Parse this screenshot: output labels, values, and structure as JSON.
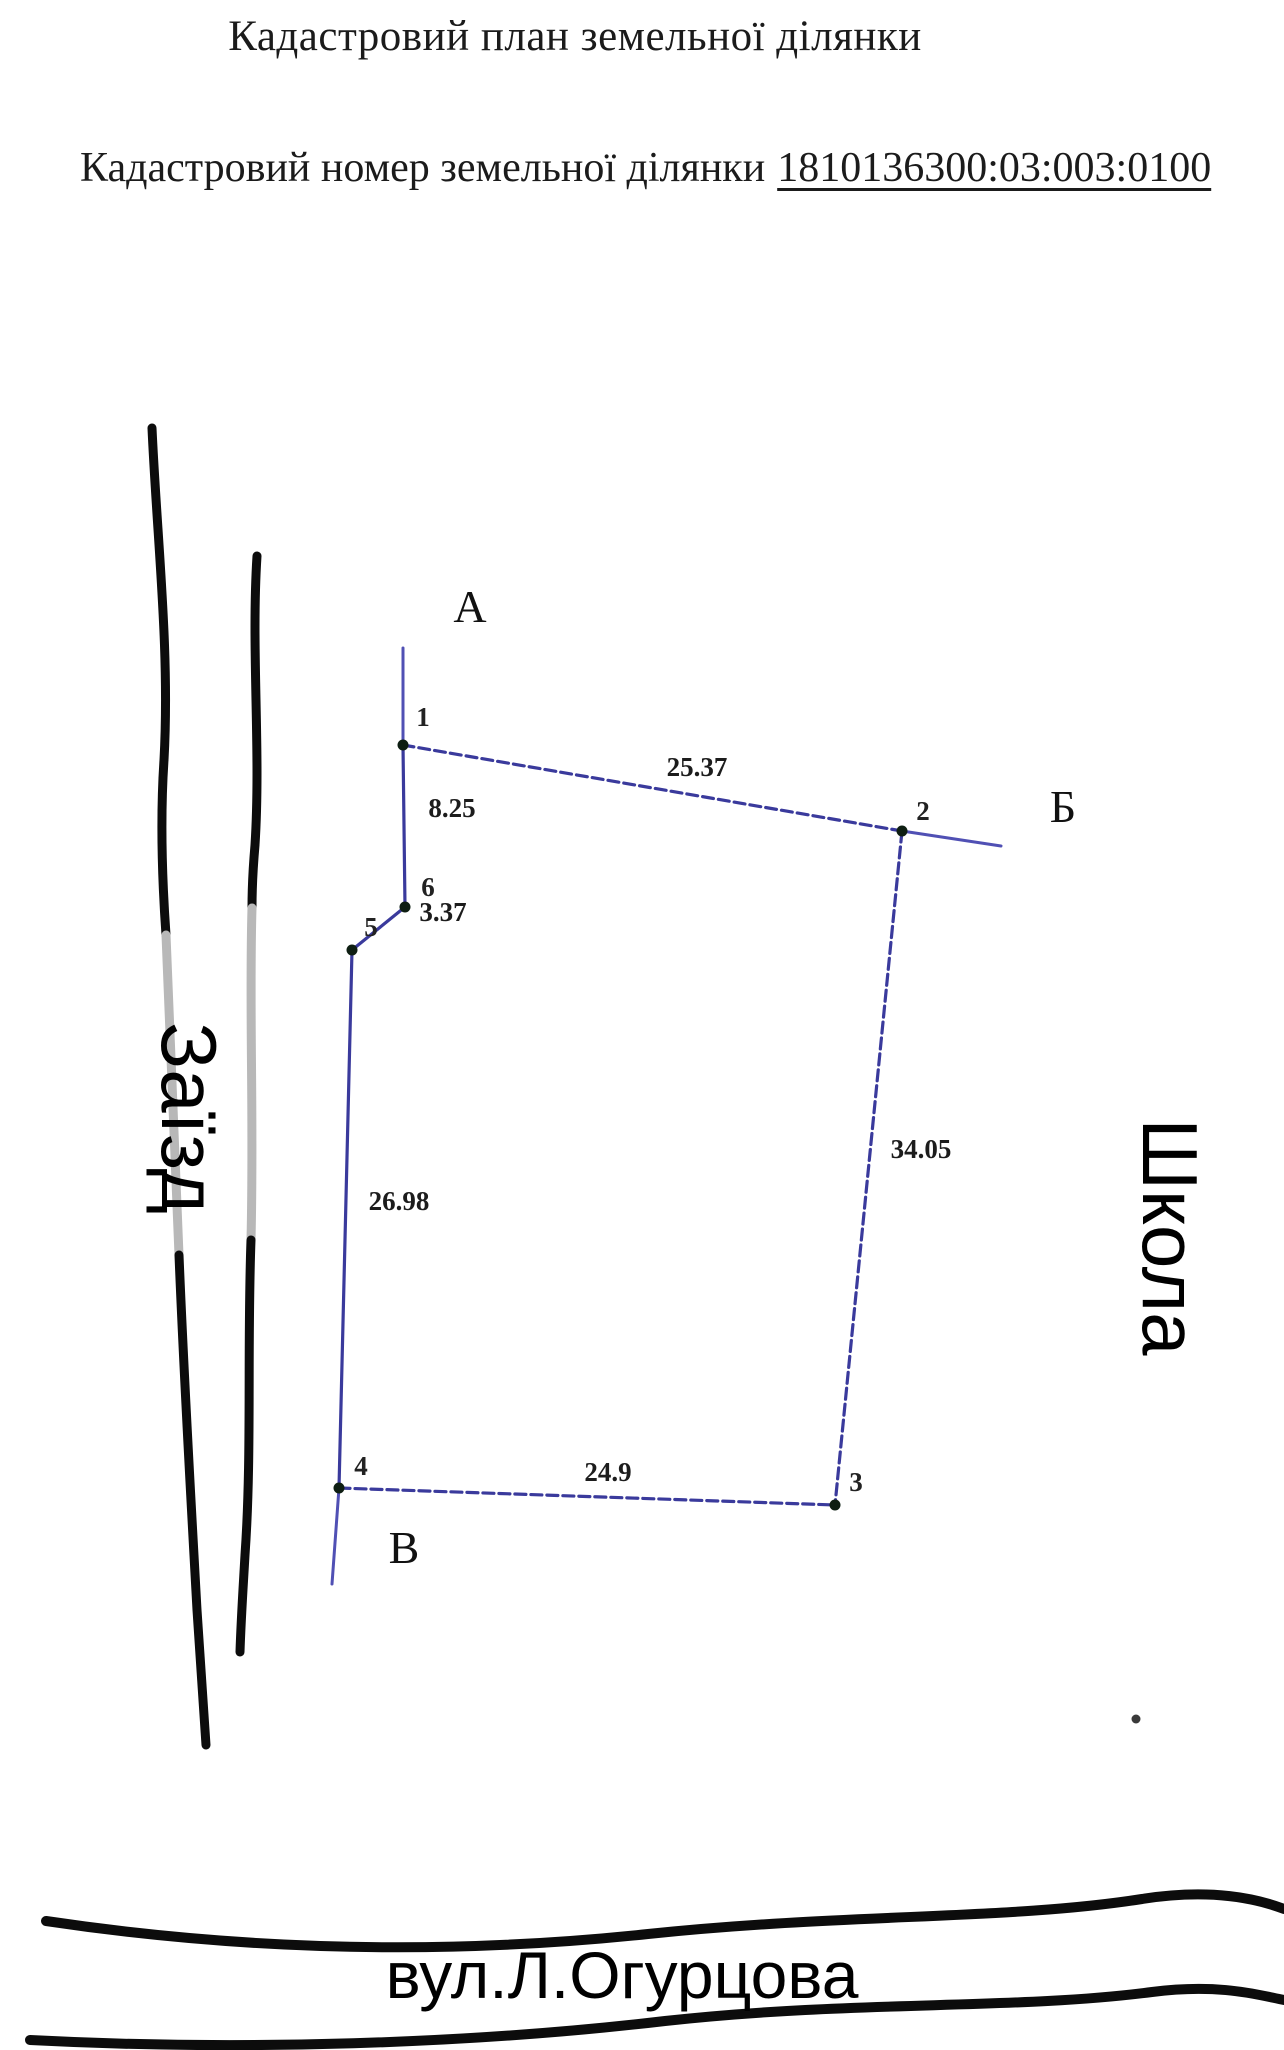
{
  "header": {
    "title": "Кадастровий план земельної ділянки",
    "subtitle_label": "Кадастровий номер земельної ділянки",
    "cadastral_number": "1810136300:03:003:0100"
  },
  "roads": {
    "left_label": "Заїзд",
    "right_label": "Школа",
    "bottom_label": "вул.Л.Огурцова"
  },
  "diagram": {
    "edge_color": "#3a3a9c",
    "extension_color": "#5050b4",
    "dot_color": "#0e1e12",
    "points": {
      "1": [
        403,
        745
      ],
      "2": [
        902,
        831
      ],
      "3": [
        835,
        1505
      ],
      "4": [
        339,
        1488
      ],
      "5": [
        352,
        950
      ],
      "6": [
        405,
        907
      ]
    },
    "edges": [
      {
        "from": "1",
        "to": "2",
        "length": "25.37",
        "label_pos": [
          697,
          776
        ],
        "dashed": true
      },
      {
        "from": "2",
        "to": "3",
        "length": "34.05",
        "label_pos": [
          921,
          1158
        ],
        "dashed": true
      },
      {
        "from": "4",
        "to": "3",
        "length": "24.9",
        "label_pos": [
          608,
          1481
        ],
        "dashed": true
      },
      {
        "from": "5",
        "to": "4",
        "length": "26.98",
        "label_pos": [
          399,
          1210
        ],
        "dashed": false
      },
      {
        "from": "6",
        "to": "5",
        "length": "3.37",
        "label_pos": [
          443,
          921
        ],
        "dashed": false
      },
      {
        "from": "1",
        "to": "6",
        "length": "8.25",
        "label_pos": [
          452,
          817
        ],
        "dashed": false
      }
    ],
    "extensions": [
      {
        "from": [
          403,
          648
        ],
        "to": [
          403,
          745
        ]
      },
      {
        "from": [
          902,
          831
        ],
        "to": [
          1001,
          846
        ]
      },
      {
        "from": [
          339,
          1488
        ],
        "to": [
          332,
          1584
        ]
      }
    ],
    "vertex_labels": [
      {
        "text": "1",
        "pos": [
          423,
          726
        ]
      },
      {
        "text": "2",
        "pos": [
          923,
          820
        ]
      },
      {
        "text": "3",
        "pos": [
          856,
          1491
        ]
      },
      {
        "text": "4",
        "pos": [
          361,
          1475
        ]
      },
      {
        "text": "5",
        "pos": [
          371,
          936
        ]
      },
      {
        "text": "6",
        "pos": [
          428,
          896
        ]
      }
    ],
    "corner_letters": [
      {
        "text": "А",
        "pos": [
          470,
          622
        ]
      },
      {
        "text": "Б",
        "pos": [
          1063,
          822
        ]
      },
      {
        "text": "В",
        "pos": [
          404,
          1563
        ]
      }
    ]
  }
}
